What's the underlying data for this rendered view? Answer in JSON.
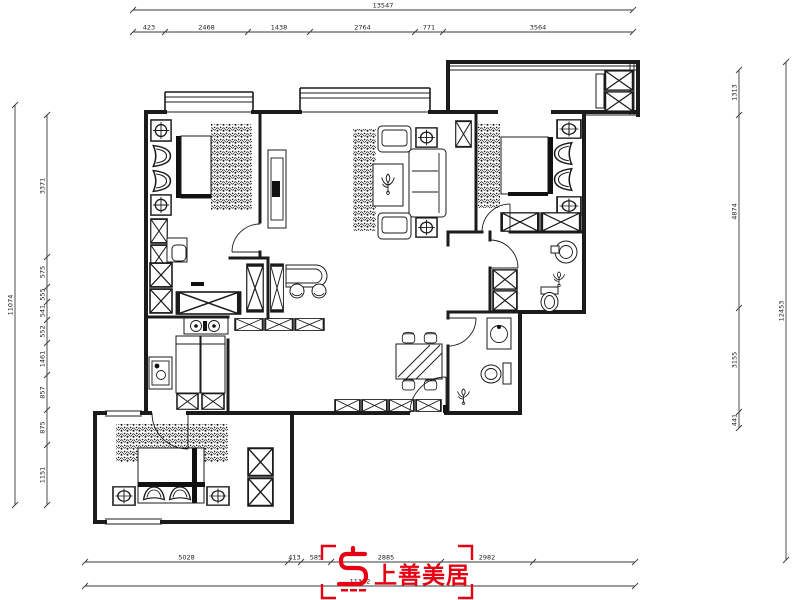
{
  "logo": {
    "text": "上善美居",
    "color": "#e60012"
  },
  "colors": {
    "background": "#ffffff",
    "line": "#1b1b1b",
    "dimension": "#3a3a3a"
  },
  "dimensions": {
    "top": {
      "overall": "13547",
      "segments": [
        "423",
        "2468",
        "1438",
        "2764",
        "771",
        "3564"
      ]
    },
    "bottom": {
      "overall": "11382",
      "segments": [
        "5028",
        "413",
        "585",
        "2885",
        "2982"
      ]
    },
    "left": {
      "overall": "11074",
      "segments": [
        "3371",
        "575",
        "555",
        "541",
        "552",
        "1461",
        "857",
        "875",
        "1151"
      ]
    },
    "right": {
      "overall": "12453",
      "segments": [
        "1313",
        "4874",
        "3155",
        "441"
      ]
    }
  },
  "icons": {
    "cabinet": "x-crossed-cabinet",
    "lamp_table": "circle-cross-lamp",
    "plant_band": "dense-foliage-hatch",
    "plant_pot": "potted-plant",
    "door": "quarter-arc-door"
  }
}
